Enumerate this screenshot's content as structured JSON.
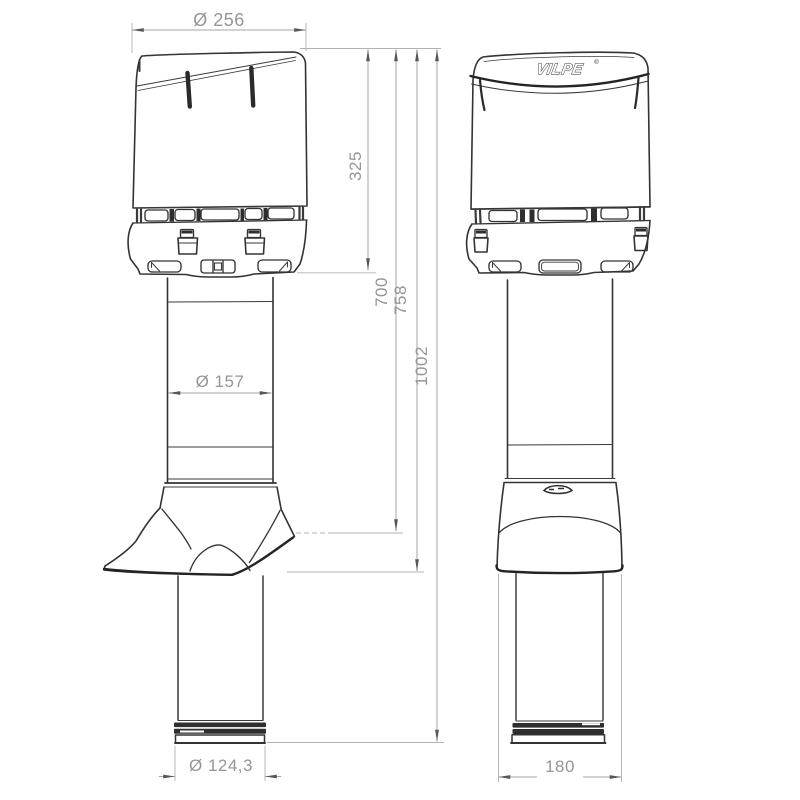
{
  "brand": {
    "logo": "VILPE",
    "registered_mark": "®"
  },
  "dimensions": {
    "cap_diameter": "Ø 256",
    "cap_assembly_height": "325",
    "height_to_roofline": "700",
    "flashing_bottom_height": "758",
    "total_height": "1002",
    "pipe_diameter": "Ø 157",
    "bottom_pipe_diameter": "Ø 124,3",
    "flashing_skirt_width": "180"
  },
  "colors": {
    "background": "#ffffff",
    "drawing_line": "#333333",
    "dimension_line": "#a3a6a9",
    "dimension_text": "#939699",
    "arrow": "#55585a"
  }
}
